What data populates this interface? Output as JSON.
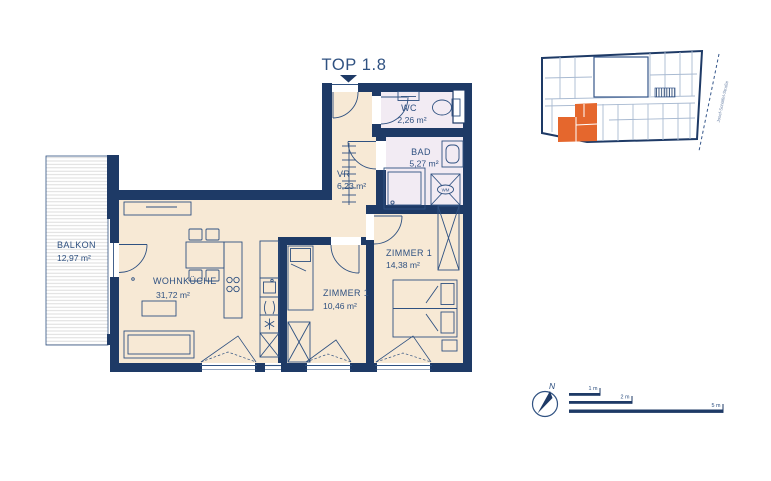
{
  "title": "TOP 1.8",
  "rooms": {
    "wc": {
      "name": "WC",
      "area": "2,26 m²"
    },
    "bad": {
      "name": "BAD",
      "area": "5,27 m²"
    },
    "vr": {
      "name": "VR",
      "area": "6,23 m²"
    },
    "zimmer1": {
      "name": "ZIMMER 1",
      "area": "14,38 m²"
    },
    "zimmer2": {
      "name": "ZIMMER 1",
      "area": "10,46 m²"
    },
    "wohnkueche": {
      "name": "WOHNKÜCHE",
      "area": "31,72 m²"
    },
    "balkon": {
      "name": "BALKON",
      "area": "12,97 m²"
    }
  },
  "fixtures": {
    "washing_machine": "WM"
  },
  "overview_map": {
    "street_label": "Josef-Schöffel-Straße",
    "highlight_color": "#e5672d"
  },
  "compass": {
    "north_label": "N"
  },
  "scale_bar": {
    "bars": [
      {
        "label": "1 m"
      },
      {
        "label": "2 m"
      },
      {
        "label": "5 m"
      }
    ]
  },
  "colors": {
    "wall": "#1e3a66",
    "line": "#2f5181",
    "label_text": "#2f5181",
    "floor_main": "#f7e9d5",
    "floor_wet": "#f2ebf3",
    "map_light_line": "#a9bad1",
    "street_text": "#7288ab"
  }
}
